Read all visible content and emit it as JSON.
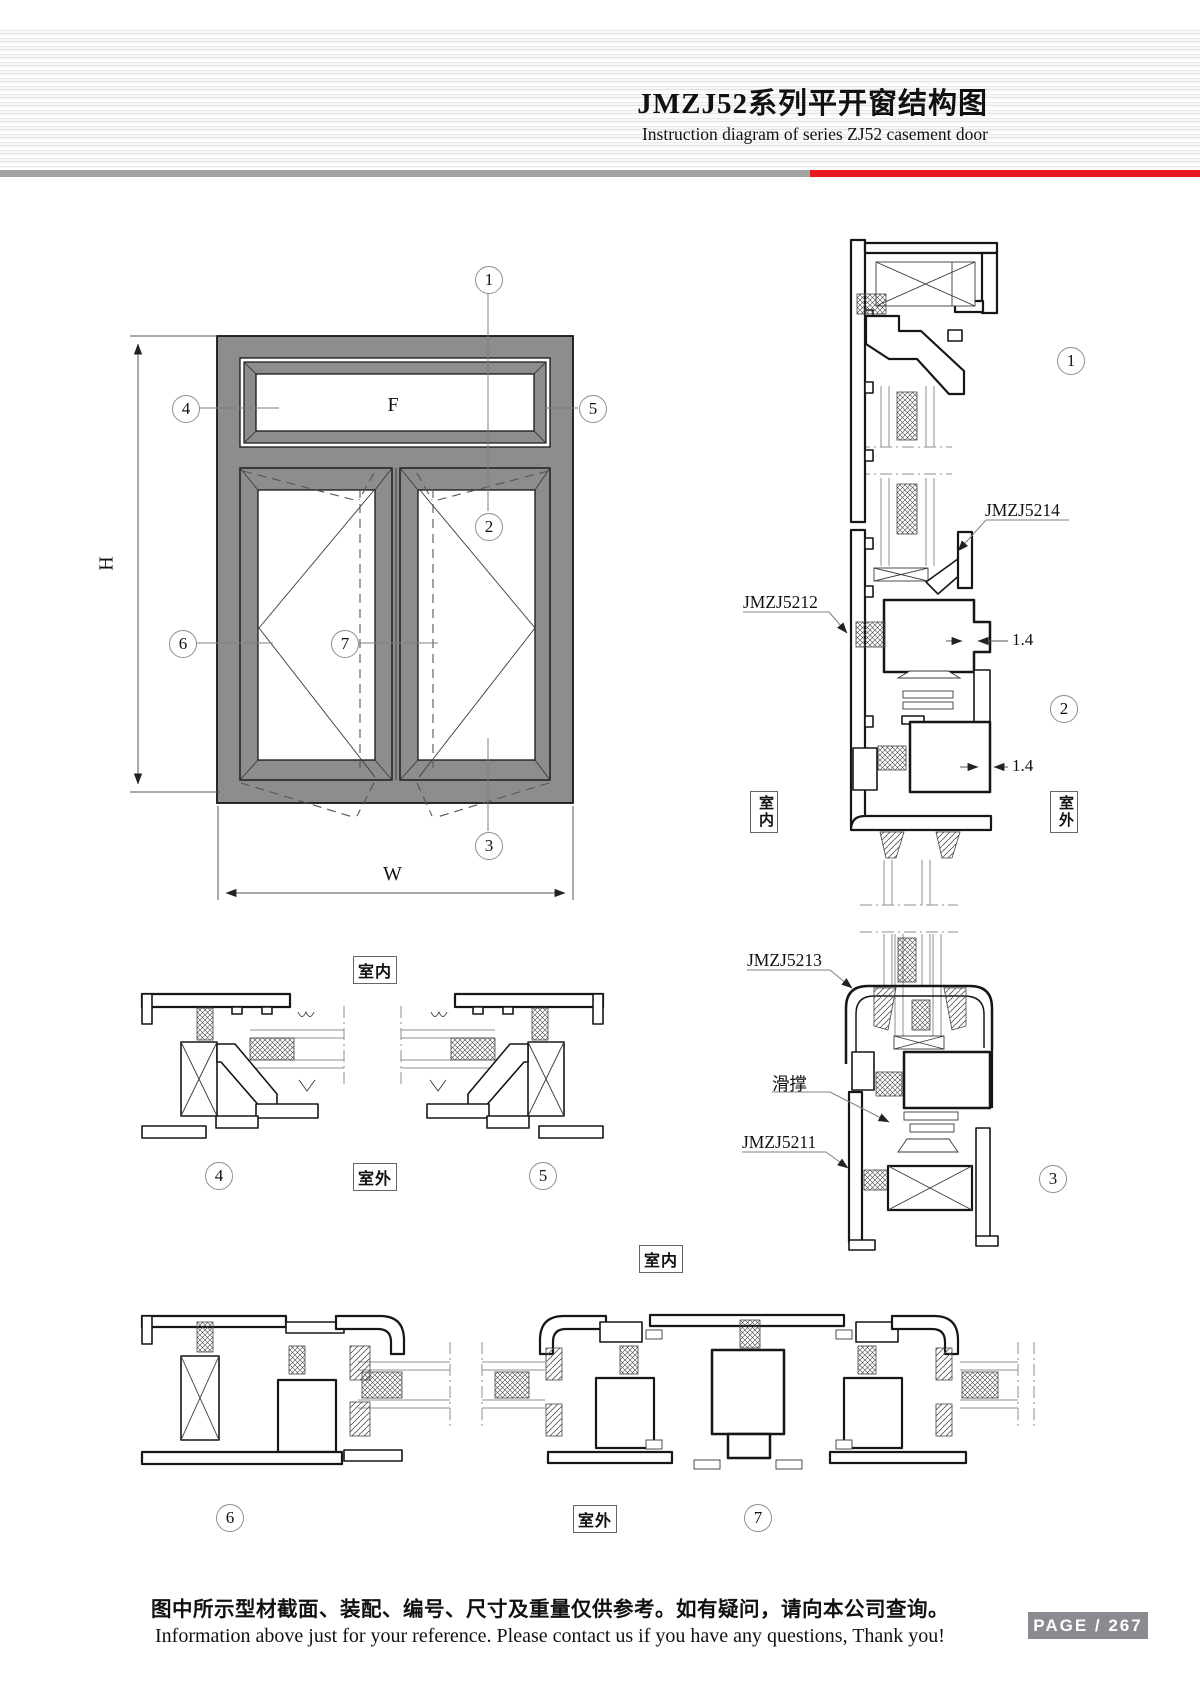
{
  "header": {
    "title": "JMZJ52系列平开窗结构图",
    "subtitle": "Instruction diagram of series ZJ52 casement door"
  },
  "elevation": {
    "fixed_panel": "F",
    "height_dim": "H",
    "width_dim": "W"
  },
  "callouts": {
    "c1": "1",
    "c2": "2",
    "c3": "3",
    "c4": "4",
    "c5": "5",
    "c6": "6",
    "c7": "7"
  },
  "labels": {
    "head_sash_profile": "JMZJ5214",
    "frame_profile": "JMZJ5212",
    "transom_profile": "JMZJ5213",
    "sill_profile": "JMZJ5211",
    "friction_stay": "滑撑",
    "wall_thickness": "1.4",
    "indoor": "室内",
    "outdoor": "室外"
  },
  "footer": {
    "note_zh": "图中所示型材截面、装配、编号、尺寸及重量仅供参考。如有疑问，请向本公司查询。",
    "note_en": "Information above just for your reference. Please contact us if you have any questions, Thank you!",
    "page_label": "PAGE / 267"
  },
  "colors": {
    "accent_red": "#e8191e",
    "rule_gray": "#a4a4a4",
    "frame_gray": "#8d8d8d",
    "line_color": "#161616",
    "badge_gray": "#8a8a90"
  }
}
